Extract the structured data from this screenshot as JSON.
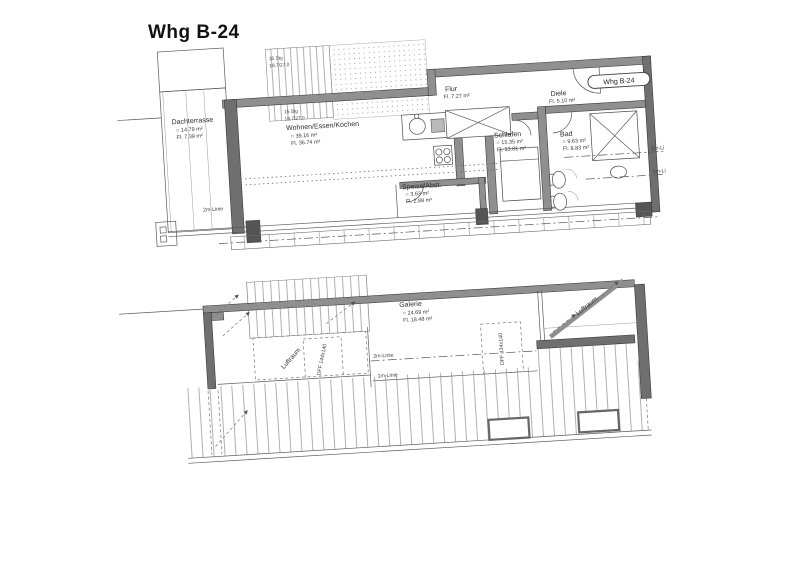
{
  "title": "Whg B-24",
  "upper_plan": {
    "tag": "Whg B-24",
    "rooms": [
      {
        "name": "Dachterrasse",
        "line1": "○  14.79 m²",
        "line2": "Fl.  7.39 m²"
      },
      {
        "name": "Wohnen/Essen/Kochen",
        "line1": "○  39.16 m²",
        "line2": "Fl.  36.74 m²"
      },
      {
        "name": "Flur",
        "line1": "Fl.  7.27 m²"
      },
      {
        "name": "Diele",
        "line1": "Fl.  5.10 m²"
      },
      {
        "name": "Schlafen",
        "line1": "○  15.35 m²",
        "line2": "Fl.  13.81 m²"
      },
      {
        "name": "Bad",
        "line1": "○  9.63 m²",
        "line2": "Fl.  8.83 m²"
      },
      {
        "name": "Speise/Abst.",
        "line1": "○  3.63 m²",
        "line2": "Fl.  2.88 m²"
      }
    ],
    "stair_label": {
      "line1": "15 Stg",
      "line2": "18,7/27,0"
    },
    "marks": {
      "m2_left": "2m-Linie",
      "m2_right": "2m-Li",
      "m1_right": "1m-Li"
    }
  },
  "lower_plan": {
    "rooms": [
      {
        "name": "Galerie",
        "line1": "○  24.69 m²",
        "line2": "Fl.  18.48 m²"
      }
    ],
    "marks": {
      "luftraum_left": "Luftraum",
      "luftraum_right": "Luftraum",
      "dff_left": "DFF 144x140",
      "dff_right": "DFF 134x140",
      "m2": "2m-Linie",
      "m1": "1m-Linie"
    }
  }
}
